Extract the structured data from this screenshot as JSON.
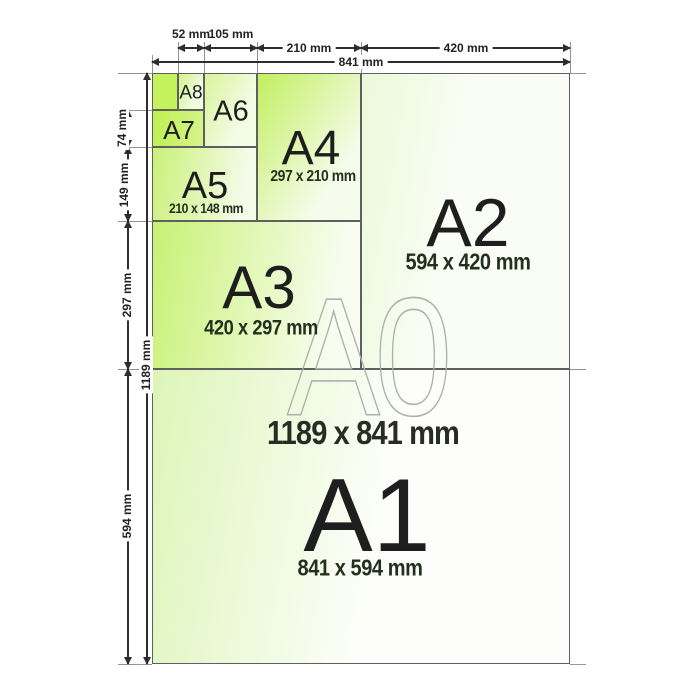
{
  "papers": {
    "a0": {
      "label": "A0",
      "size": "1189 x 841 mm"
    },
    "a1": {
      "label": "A1",
      "size": "841 x 594 mm"
    },
    "a2": {
      "label": "A2",
      "size": "594 x 420 mm"
    },
    "a3": {
      "label": "A3",
      "size": "420 x 297 mm"
    },
    "a4": {
      "label": "A4",
      "size": "297 x 210 mm"
    },
    "a5": {
      "label": "A5",
      "size": "210 x 148 mm"
    },
    "a6": {
      "label": "A6"
    },
    "a7": {
      "label": "A7"
    },
    "a8": {
      "label": "A8"
    }
  },
  "dimensions": {
    "top": {
      "w52": "52 mm",
      "w105": "105 mm",
      "w210": "210 mm",
      "w420": "420 mm",
      "w841": "841 mm"
    },
    "left": {
      "h74": "74 mm",
      "h149": "149 mm",
      "h297": "297 mm",
      "h594": "594 mm",
      "h1189": "1189 mm"
    }
  },
  "colors": {
    "accent_green": "#c3f157",
    "paper_line": "#5f5f5f",
    "dimension_line": "#2e2e2e",
    "watermark_outline": "#aeaeae"
  }
}
